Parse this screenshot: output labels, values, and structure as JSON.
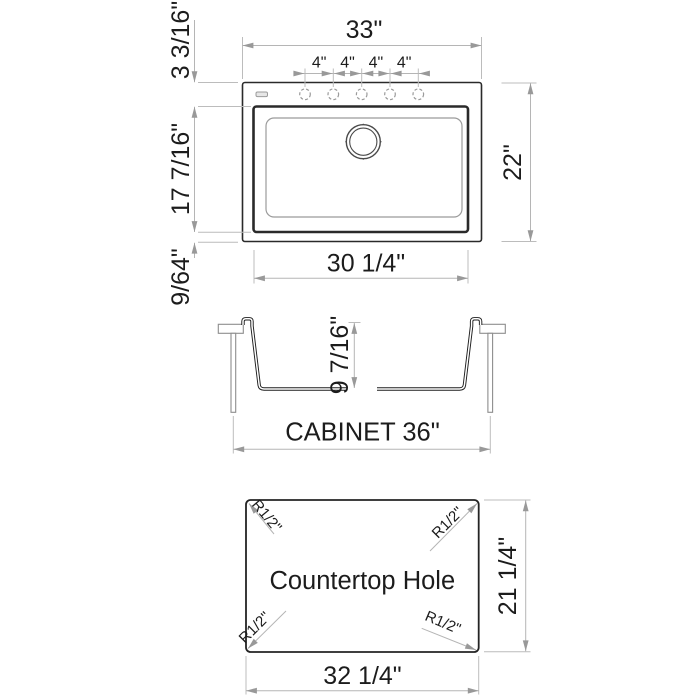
{
  "drawing_title": "Drop-in kitchen sink specification drawing",
  "colors": {
    "background": "#ffffff",
    "drawing_ink": "#2a2a2a",
    "secondary_line": "#9b9b9b",
    "dimension_line": "#b5b5b5",
    "arrow": "#999999",
    "text": "#1c1c1c"
  },
  "top_view": {
    "overall_width": "33\"",
    "overall_depth": "22\"",
    "faucet_hole_spacings": [
      "4\"",
      "4\"",
      "4\"",
      "4\""
    ],
    "deck_to_bowl": "3 3/16\"",
    "bowl_front_to_back": "17 7/16\"",
    "bowl_to_front_edge": "9/64\"",
    "bowl_width": "30 1/4\""
  },
  "section_view": {
    "bowl_depth": "9 7/16\"",
    "cabinet_label": "CABINET 36\""
  },
  "cutout_view": {
    "title": "Countertop Hole",
    "width": "32 1/4\"",
    "depth": "21 1/4\"",
    "corner_radii": [
      "R1/2\"",
      "R1/2\"",
      "R1/2\"",
      "R1/2\""
    ]
  }
}
